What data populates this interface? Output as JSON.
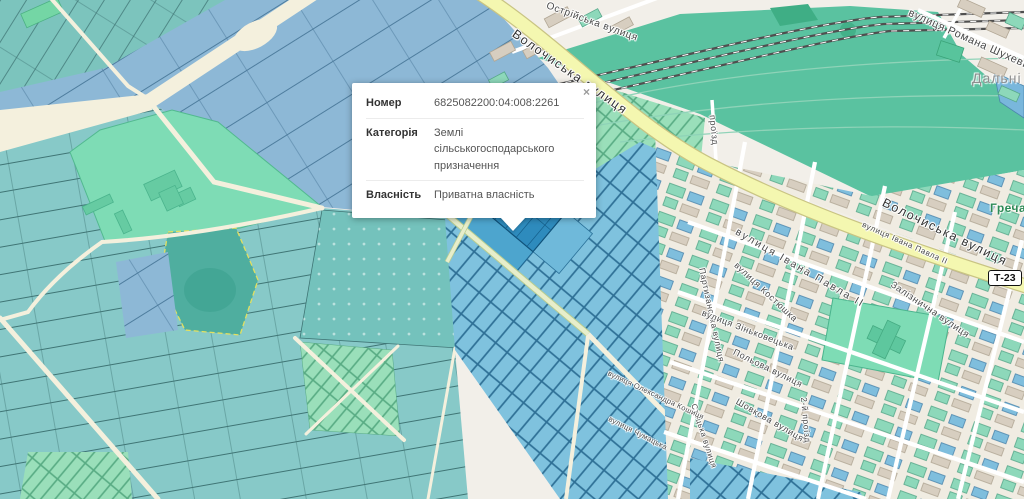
{
  "popup": {
    "close_label": "×",
    "rows": [
      {
        "label": "Номер",
        "value": "6825082200:04:008:2261"
      },
      {
        "label": "Категорія",
        "value": "Землі сільськогосподарського призначення"
      },
      {
        "label": "Власність",
        "value": "Приватна власність"
      }
    ]
  },
  "map": {
    "road_badge": "Т-23",
    "place_labels": [
      {
        "text": "Дальні"
      },
      {
        "text": "Гречани"
      }
    ],
    "street_labels": [
      {
        "text": "Волочиська вулиця"
      },
      {
        "text": "Волочиська вулиця"
      },
      {
        "text": "Острійська вулиця"
      },
      {
        "text": "вулиця Романа Шухевича"
      },
      {
        "text": "проїзд"
      },
      {
        "text": "вулиця Івана Павла ІІ"
      },
      {
        "text": "вулиця Івана Павла ІІ"
      },
      {
        "text": "Залізнична вулиця"
      },
      {
        "text": "вулиця Костюшка"
      },
      {
        "text": "Партизанська вулиця"
      },
      {
        "text": "вулиця Зіньковецька"
      },
      {
        "text": "Польова вулиця"
      },
      {
        "text": "Шовкова вулиця"
      },
      {
        "text": "2-й проїзд"
      },
      {
        "text": "Стоцька вулиця"
      },
      {
        "text": "вулиця Олександра Кошиця"
      },
      {
        "text": "вулиця Чумацька"
      }
    ],
    "colors": {
      "background_cream": "#f2efe9",
      "parcel_blue": "#8db8d6",
      "parcel_teal": "#87c9c8",
      "parcel_grid_blue": "#7fc2de",
      "selected_parcel": "#2e8bbd",
      "farm_mint": "#7edcb5",
      "rail_yard_green": "#5ac2a0",
      "road_yellow": "#f4f7b0",
      "road_cream": "#f4f0dd",
      "building_green": "#8dd8ba",
      "building_blue": "#7fbedd",
      "building_beige": "#d7cec0"
    }
  }
}
